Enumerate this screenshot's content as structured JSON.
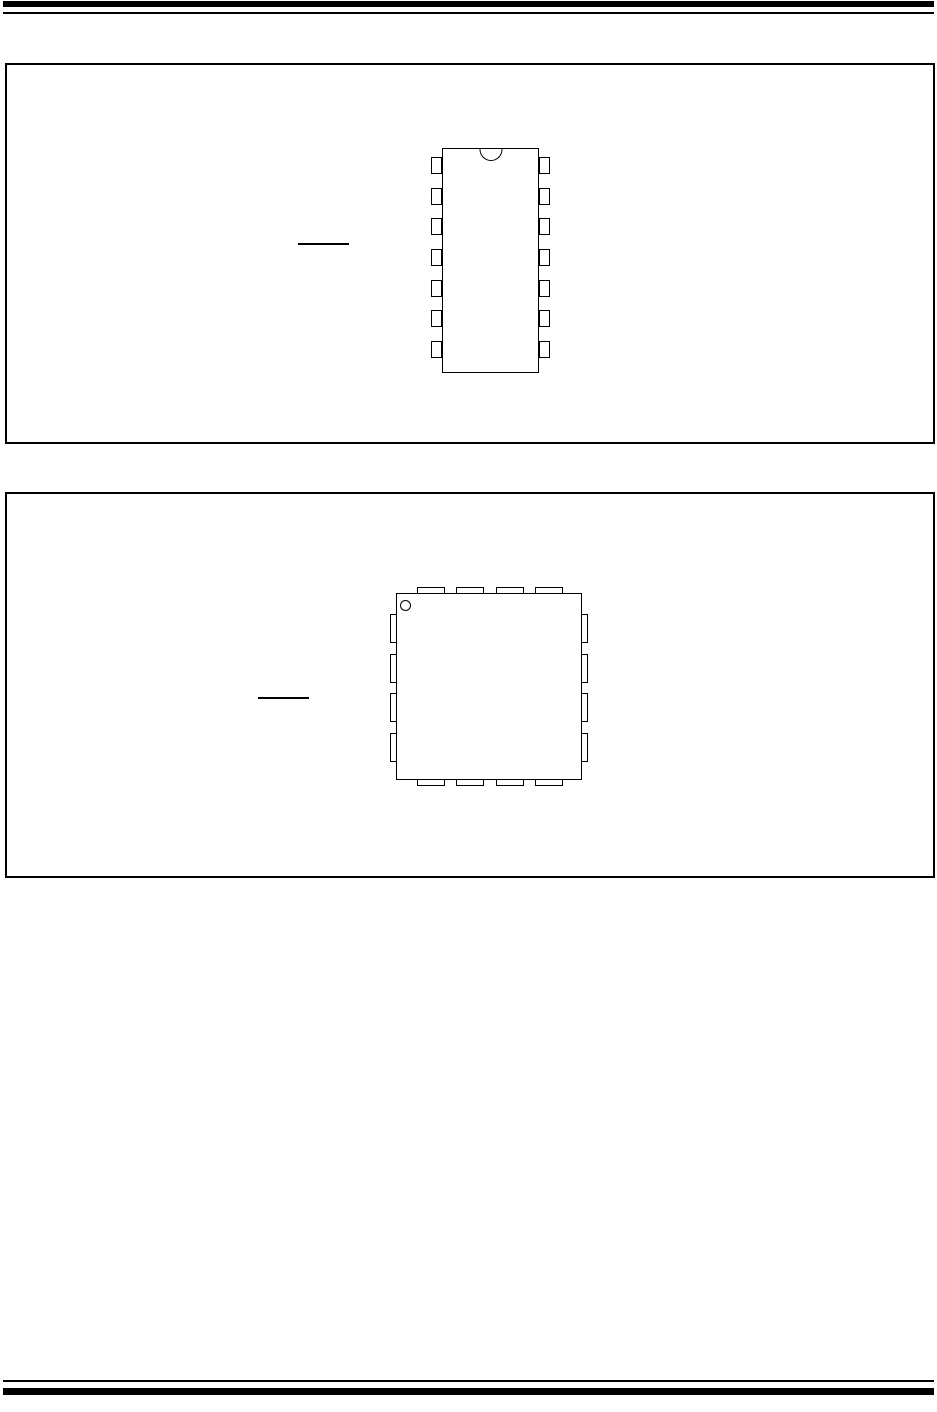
{
  "page": {
    "kind": "datasheet-package-pinout-page",
    "background_color": "#ffffff",
    "ink_color": "#000000"
  },
  "header": {
    "thick_bar": true,
    "thin_rule": true
  },
  "figures": {
    "dip": {
      "package_outline": "14-lead dual in-line",
      "pins_per_side": 7,
      "total_pins": 14,
      "pin1_indicator": "top-center notch",
      "overline_label_text": ""
    },
    "qfn": {
      "package_outline": "16-lead quad flat",
      "pins_top": 4,
      "pins_bottom": 4,
      "pins_left": 4,
      "pins_right": 4,
      "total_pins": 16,
      "pin1_indicator": "top-left corner dot",
      "overline_label_text": ""
    }
  },
  "footer": {
    "thin_rule": true,
    "thick_bar": true
  }
}
